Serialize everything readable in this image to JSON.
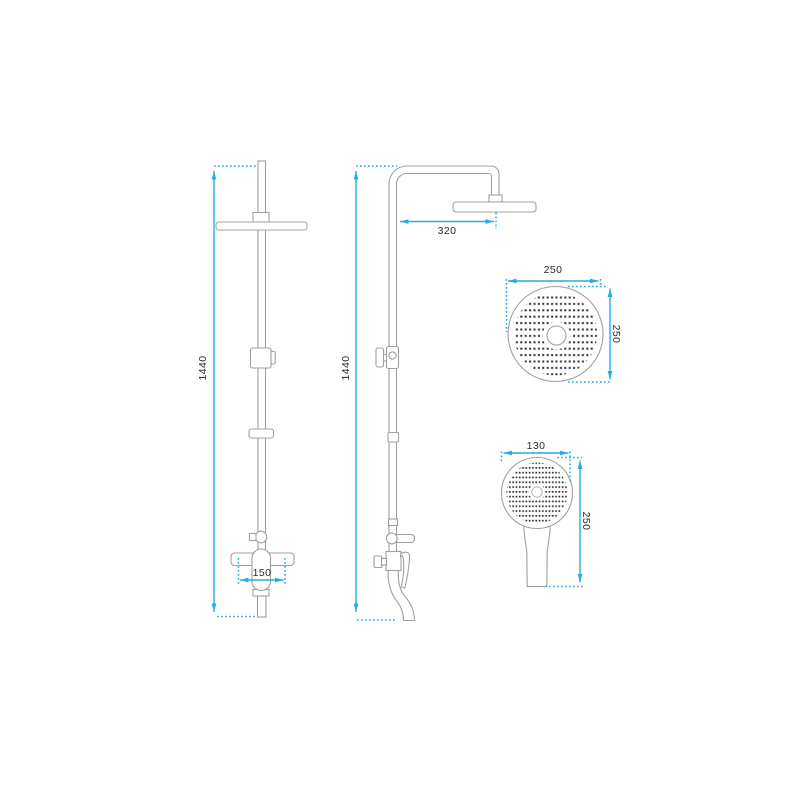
{
  "drawing": {
    "front_view": {
      "height": "1440",
      "mixer_center_distance": "150"
    },
    "side_view": {
      "height": "1440",
      "arm_projection": "320"
    },
    "overhead_shower_view": {
      "diameter": "250",
      "height": "250"
    },
    "hand_shower_view": {
      "width": "130",
      "height": "250"
    }
  },
  "colors": {
    "dimension_line": "#29abe2",
    "drawing_outline": "#a0a0a0",
    "nozzle_dot": "#2e2e2e",
    "background": "#ffffff"
  }
}
